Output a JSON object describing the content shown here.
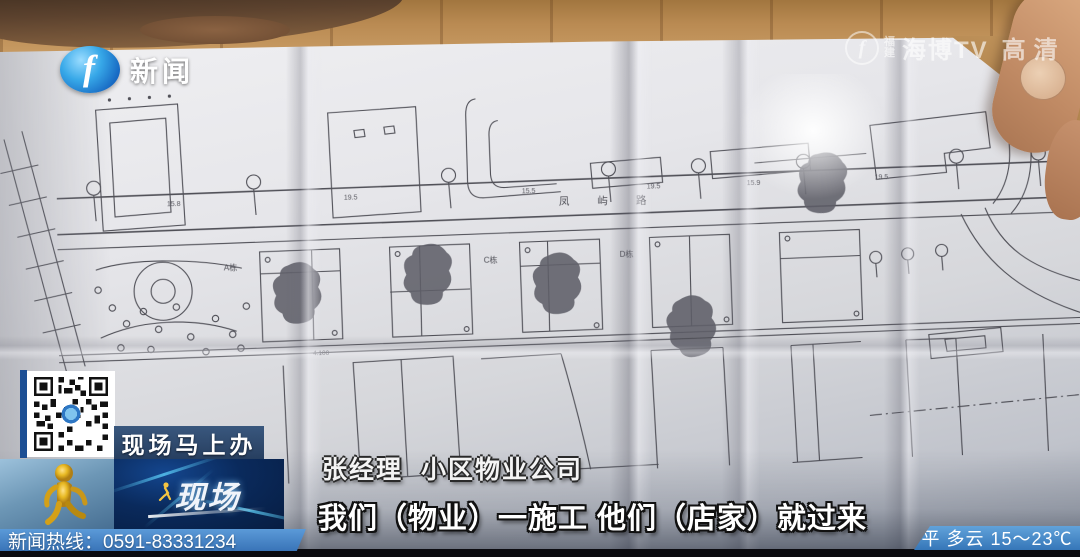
{
  "tv": {
    "logo": {
      "glyph": "f",
      "label": "新闻"
    },
    "watermark": {
      "glyph": "f",
      "region": "福建",
      "name": "海博TV",
      "quality": "高清"
    },
    "program_banner": {
      "label": "现场马上办"
    },
    "program_logo": {
      "label": "现场"
    },
    "hotline": {
      "text": "新闻热线：0591-83331234"
    },
    "weather": {
      "text": "平 多云 15～23℃"
    },
    "speaker": {
      "name": "张经理",
      "affiliation": "小区物业公司"
    },
    "subtitle": {
      "text": "我们（物业）一施工 他们（店家）就过来"
    }
  },
  "blueprint": {
    "road_name": "凤屿路",
    "labels": {
      "building_a": "A栋",
      "building_c": "C栋",
      "building_d": "D栋"
    },
    "elevation": "4.100",
    "dimensions": [
      "15.8",
      "19.5",
      "15.5",
      "19.5",
      "15.9",
      "19.5"
    ]
  },
  "colors": {
    "hotline_blue": "#3974b8",
    "banner_navy": "#1c3558",
    "program_panel_blue": "#0a2a5c",
    "mascot_gold": "#e8b923",
    "logo_blue": "#1565c0",
    "paper_gray": "#e6e6ea",
    "wood_tan": "#b98a52",
    "ink": "#3e3e46"
  }
}
